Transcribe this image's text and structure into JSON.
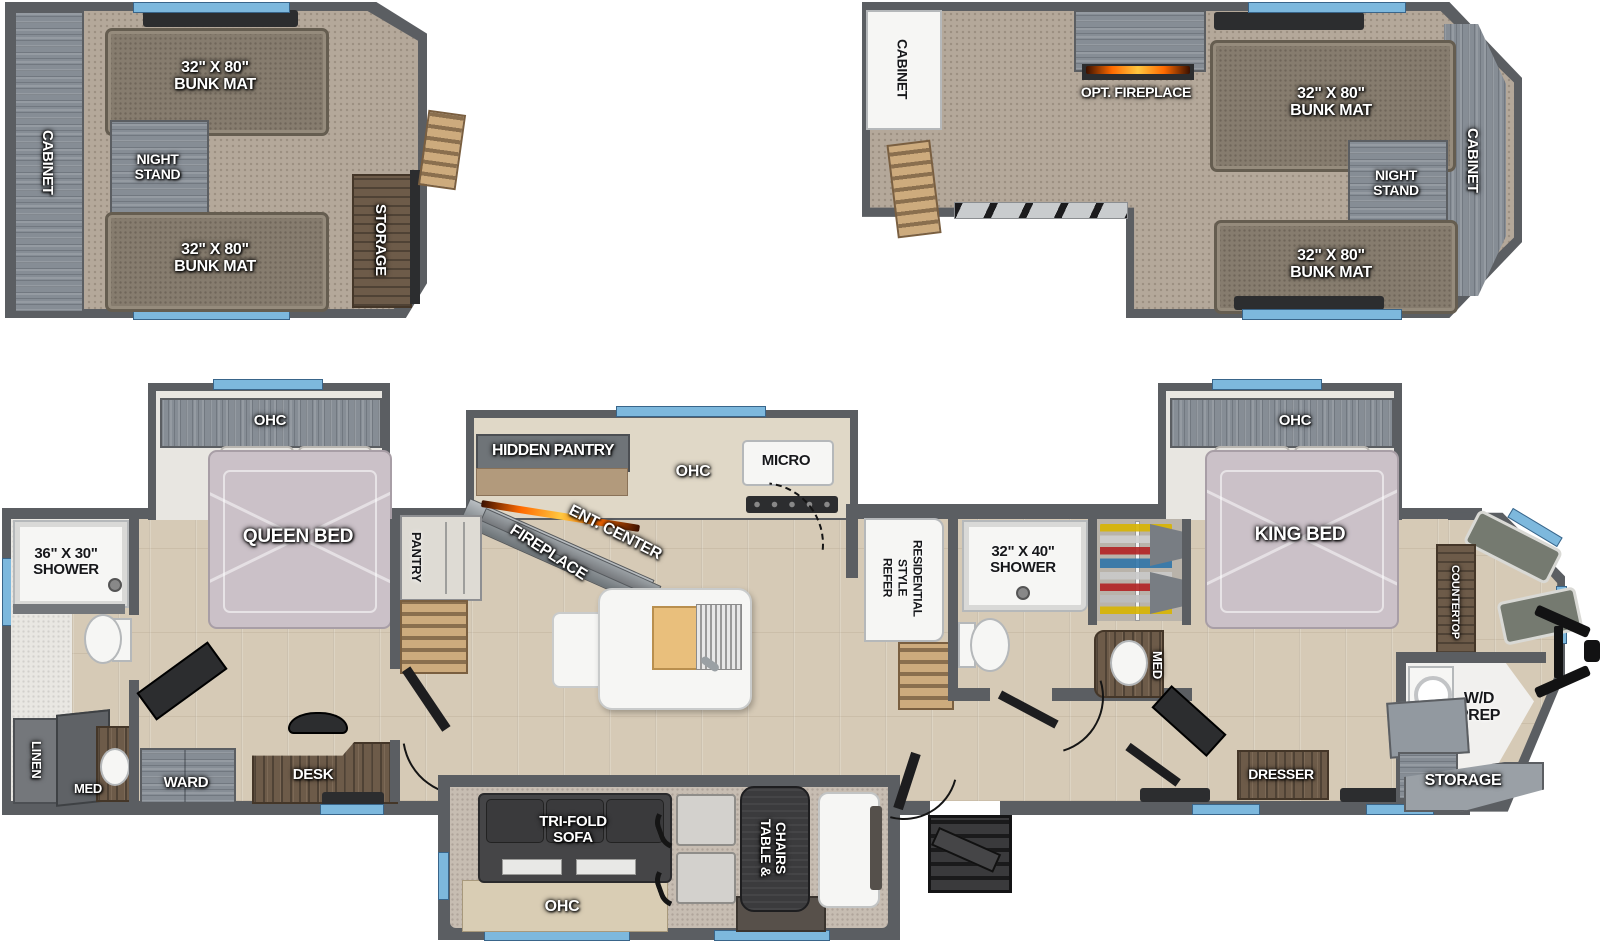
{
  "colors": {
    "wall": "#5b5e62",
    "floor_wood": "#d6cab6",
    "loft_carpet": "#b4a89a",
    "window_accent": "#7db8dd",
    "dark_wood": "#6d5b49",
    "fire_glow": "#ff6a00"
  },
  "loft_left": {
    "cabinet": "CABINET",
    "bunk_top": "32\" X 80\"\nBUNK MAT",
    "night_stand": "NIGHT\nSTAND",
    "bunk_bottom": "32\" X 80\"\nBUNK MAT",
    "storage": "STORAGE"
  },
  "loft_right": {
    "cabinet_left": "CABINET",
    "opt_fireplace": "OPT. FIREPLACE",
    "bunk_top": "32\" X 80\"\nBUNK MAT",
    "night_stand": "NIGHT\nSTAND",
    "cabinet_right": "CABINET",
    "bunk_bottom": "32\" X 80\"\nBUNK MAT"
  },
  "main": {
    "bath1": {
      "shower": "36\" X 30\"\nSHOWER",
      "linen": "LINEN",
      "med": "MED"
    },
    "bedroom1": {
      "ohc": "OHC",
      "bed": "QUEEN BED",
      "ward": "WARD",
      "desk": "DESK"
    },
    "pantry": "PANTRY",
    "kitchen": {
      "hidden_pantry": "HIDDEN PANTRY",
      "ent_center": "ENT. CENTER",
      "fireplace": "FIREPLACE",
      "ohc": "OHC",
      "micro": "MICRO"
    },
    "living": {
      "tri_fold_sofa": "TRI-FOLD\nSOFA",
      "ohc": "OHC",
      "table_chairs": "TABLE &\nCHAIRS"
    },
    "refer": "RESIDENTIAL\nSTYLE\nREFER",
    "bath2": {
      "shower": "32\" X 40\"\nSHOWER",
      "med": "MED"
    },
    "bedroom2": {
      "ohc": "OHC",
      "bed": "KING BED",
      "dresser": "DRESSER"
    },
    "front": {
      "countertop": "COUNTERTOP",
      "wd_prep": "W/D\nPREP",
      "storage": "STORAGE"
    }
  }
}
